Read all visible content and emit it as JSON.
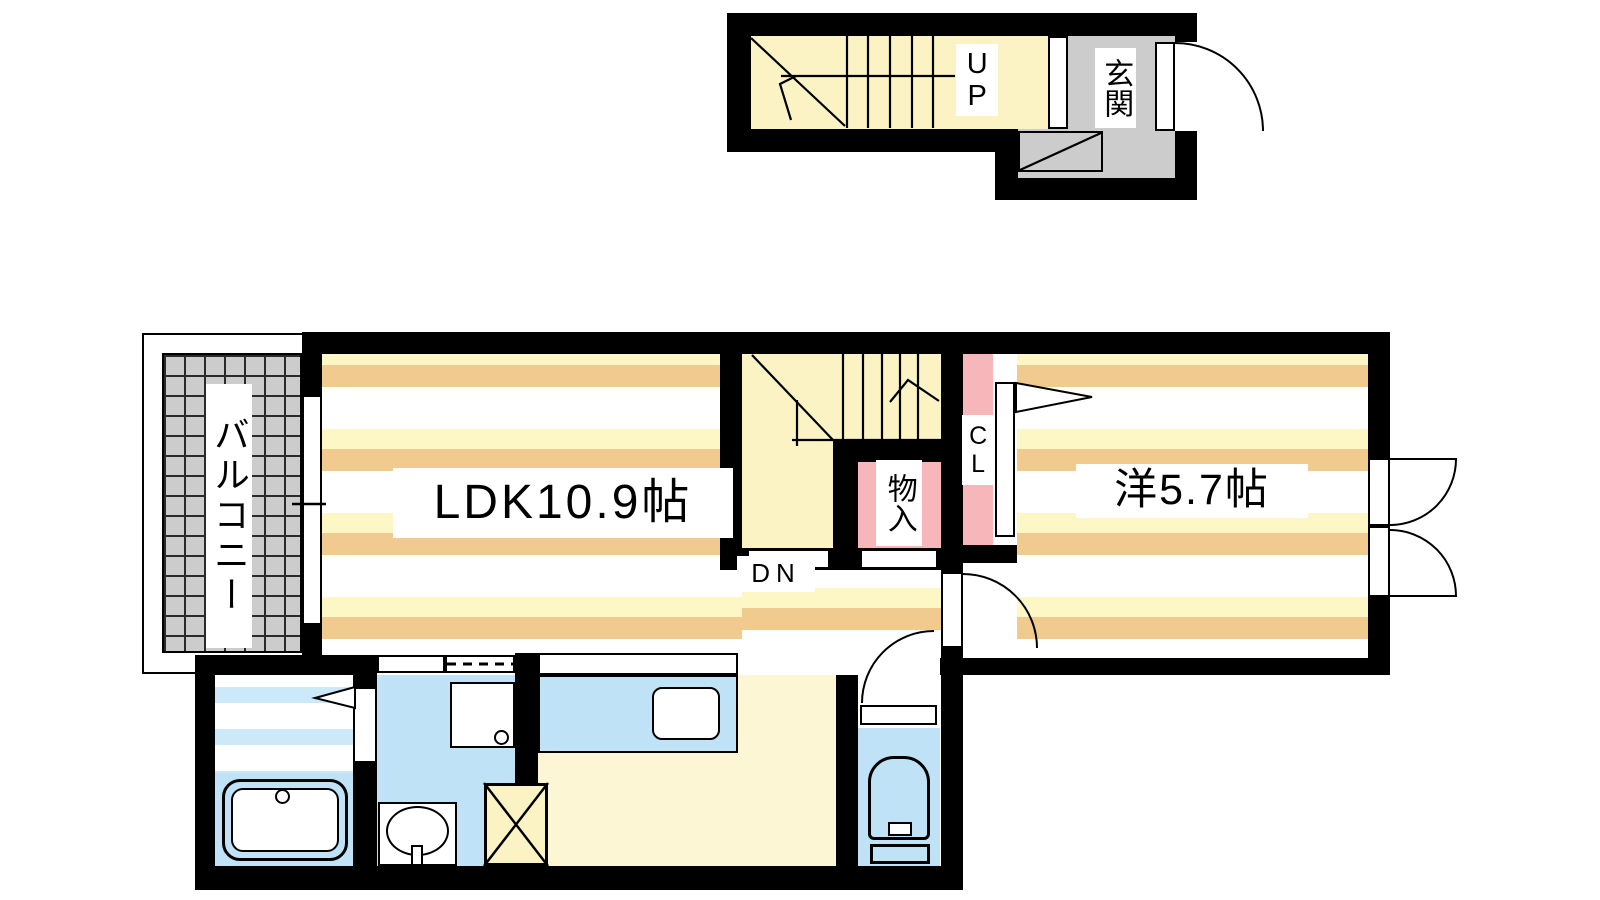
{
  "rooms": {
    "ldk": {
      "label": "LDK10.9帖"
    },
    "western_room": {
      "label": "洋5.7帖"
    },
    "balcony": {
      "label": "バルコニー"
    },
    "closet": {
      "label": "CL"
    },
    "storage": {
      "label": "物入"
    },
    "entrance": {
      "label": "玄関"
    },
    "stairs_up": {
      "label": "UP"
    },
    "stairs_down": {
      "label": "DN"
    }
  },
  "colors": {
    "wall": "#000000",
    "cream": "#FDF7C6",
    "tan": "#F1CA90",
    "hallyellow": "#FBF3C4",
    "kitchenfloor": "#FCF6D4",
    "waterblue": "#BFE2F6",
    "bathblue": "#CCE9FA",
    "pink": "#F7B6BA",
    "tilegray": "#CCCCCC",
    "gridline": "#2A2A2A"
  }
}
